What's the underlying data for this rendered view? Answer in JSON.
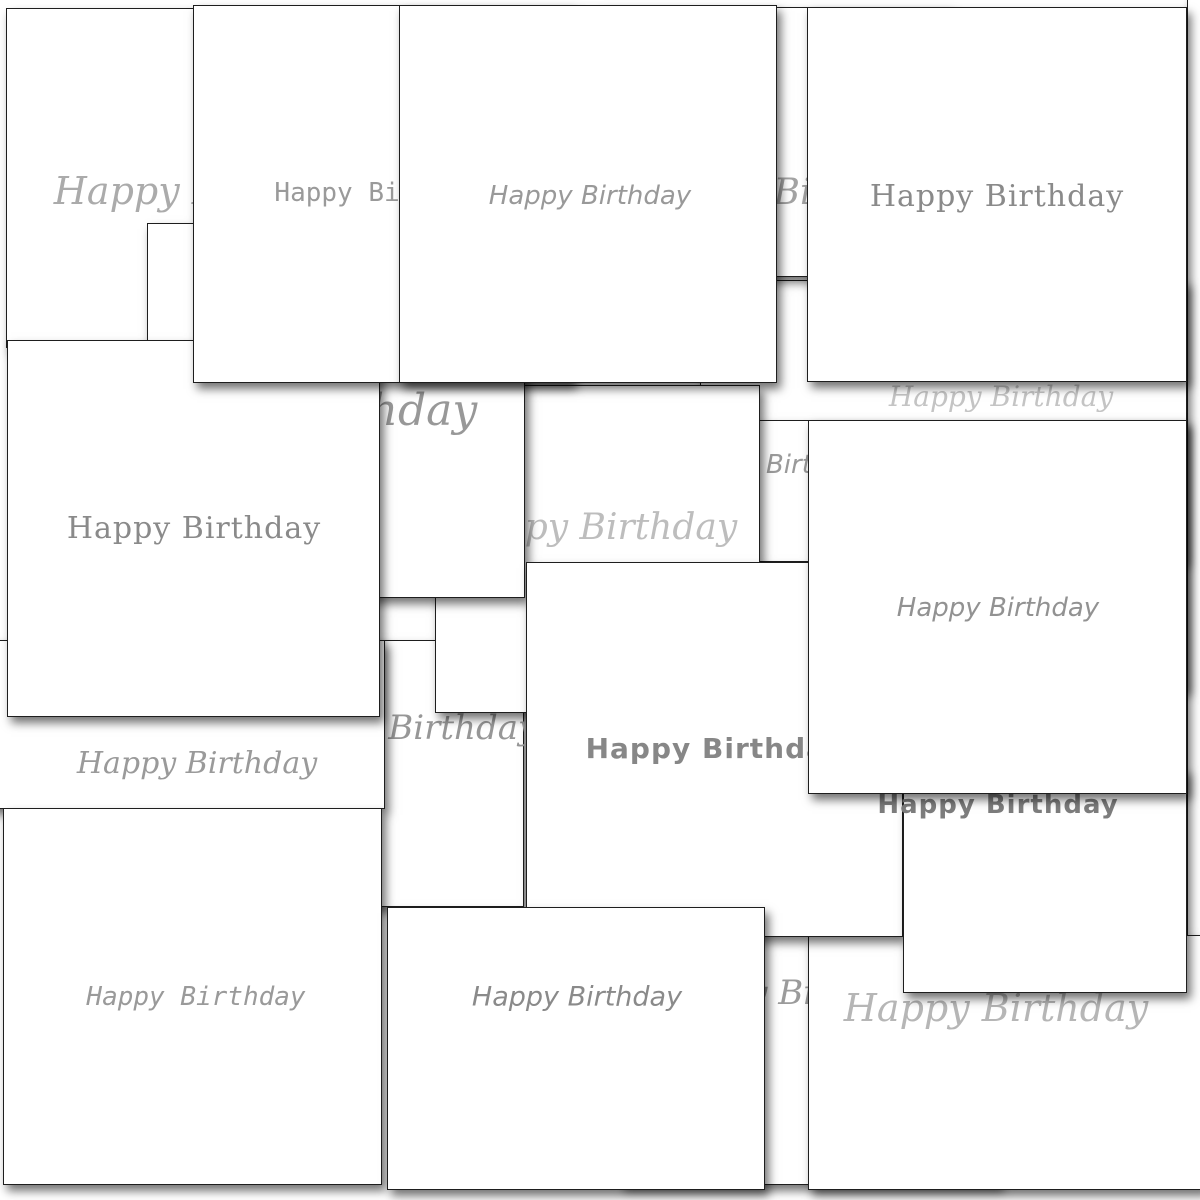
{
  "image": {
    "title": "Collage of overlapping white Happy Birthday note cards",
    "background": "#ffffff"
  },
  "greeting_text": "Happy Birthday",
  "card_style": {
    "background": "#ffffff",
    "border_color": "#1e1e1e",
    "shadow": "4px 6px 9px rgba(0,0,0,0.55)"
  },
  "cards": [
    {
      "id": "card-right-edge-sliver",
      "label": "",
      "font": "f-script",
      "size": 0,
      "color": "#ffffff",
      "x": 1187,
      "y": -5,
      "w": 28,
      "h": 950,
      "z": 1,
      "tx": 0,
      "ty": 0
    },
    {
      "id": "card-faded-script-band",
      "label": "Happy Birthday",
      "font": "f-script",
      "size": 28,
      "color": "#c4c4c4",
      "x": 700,
      "y": 280,
      "w": 487,
      "h": 410,
      "z": 2,
      "tx": 1000,
      "ty": 396
    },
    {
      "id": "card-handwriting-strip",
      "label": "Happy Birthday",
      "font": "f-hand",
      "size": 26,
      "color": "#9a9a9a",
      "x": 610,
      "y": 420,
      "w": 575,
      "h": 142,
      "z": 3,
      "tx": 774,
      "ty": 464
    },
    {
      "id": "card-top-left-thin-script",
      "label": "Happy Birthday",
      "font": "f-script",
      "size": 38,
      "color": "#ababab",
      "x": 6,
      "y": 8,
      "w": 394,
      "h": 340,
      "z": 4,
      "tx": 205,
      "ty": 190
    },
    {
      "id": "card-top-script-strip",
      "label": "Happy Birthday",
      "font": "f-script",
      "size": 36,
      "color": "#a3a3a3",
      "x": 600,
      "y": 7,
      "w": 350,
      "h": 270,
      "z": 5,
      "tx": 786,
      "ty": 192
    },
    {
      "id": "card-flourish-script-strip",
      "label": "Happy Birthday",
      "font": "f-script",
      "size": 34,
      "color": "#979797",
      "x": 180,
      "y": 640,
      "w": 344,
      "h": 267,
      "z": 6,
      "tx": 400,
      "ty": 727
    },
    {
      "id": "card-signature-script-band",
      "label": "Happy Birthday",
      "font": "f-script",
      "size": 30,
      "color": "#9a9a9a",
      "x": -20,
      "y": 640,
      "w": 405,
      "h": 169,
      "z": 7,
      "tx": 196,
      "ty": 763
    },
    {
      "id": "card-faded-script-middle",
      "label": "Happy Birthday",
      "font": "f-script",
      "size": 36,
      "color": "#bdbdbd",
      "x": 435,
      "y": 385,
      "w": 325,
      "h": 328,
      "z": 8,
      "tx": 592,
      "ty": 527
    },
    {
      "id": "card-curl-script-left",
      "label": "Happy Birthday",
      "font": "f-script",
      "size": 44,
      "color": "#989898",
      "x": 147,
      "y": 223,
      "w": 378,
      "h": 375,
      "z": 9,
      "tx": 300,
      "ty": 410
    },
    {
      "id": "card-curly-script-bottom",
      "label": "Happy Birthday",
      "font": "f-script",
      "size": 34,
      "color": "#9b9b9b",
      "x": 620,
      "y": 800,
      "w": 380,
      "h": 385,
      "z": 10,
      "tx": 790,
      "ty": 992
    },
    {
      "id": "card-thin-script-bottom-right",
      "label": "Happy Birthday",
      "font": "f-script",
      "size": 38,
      "color": "#b6b6b6",
      "x": 808,
      "y": 935,
      "w": 397,
      "h": 255,
      "z": 11,
      "tx": 995,
      "ty": 1007
    },
    {
      "id": "card-bold-sans-middle",
      "label": "Happy Birthday",
      "font": "f-bold-sans",
      "size": 28,
      "color": "#878787",
      "x": 526,
      "y": 562,
      "w": 377,
      "h": 375,
      "z": 12,
      "tx": 714,
      "ty": 748
    },
    {
      "id": "card-serif-left",
      "label": "Happy Birthday",
      "font": "f-serif",
      "size": 30,
      "color": "#8a8a8a",
      "x": 7,
      "y": 340,
      "w": 373,
      "h": 377,
      "z": 13,
      "tx": 193,
      "ty": 528
    },
    {
      "id": "card-typewriter-bottom-left",
      "label": "Happy Birthday",
      "font": "f-mono-italic",
      "size": 26,
      "color": "#9a9a9a",
      "x": 3,
      "y": 808,
      "w": 379,
      "h": 377,
      "z": 14,
      "tx": 195,
      "ty": 996
    },
    {
      "id": "card-print-bottom-center",
      "label": "Happy Birthday",
      "font": "f-hand",
      "size": 27,
      "color": "#8a8a8a",
      "x": 387,
      "y": 907,
      "w": 378,
      "h": 283,
      "z": 15,
      "tx": 576,
      "ty": 996
    },
    {
      "id": "card-bold-sans-bottom-right",
      "label": "Happy Birthday",
      "font": "f-bold-sans",
      "size": 26,
      "color": "#7d7d7d",
      "x": 903,
      "y": 768,
      "w": 284,
      "h": 225,
      "z": 16,
      "tx": 997,
      "ty": 804
    },
    {
      "id": "card-typewriter-top",
      "label": "Happy Birthday",
      "font": "f-mono",
      "size": 26,
      "color": "#9a9a9a",
      "x": 193,
      "y": 5,
      "w": 380,
      "h": 378,
      "z": 17,
      "tx": 383,
      "ty": 192
    },
    {
      "id": "card-print-top-center",
      "label": "Happy Birthday",
      "font": "f-hand",
      "size": 26,
      "color": "#999999",
      "x": 399,
      "y": 5,
      "w": 378,
      "h": 378,
      "z": 18,
      "tx": 589,
      "ty": 195
    },
    {
      "id": "card-serif-top-right",
      "label": "Happy Birthday",
      "font": "f-serif",
      "size": 30,
      "color": "#8a8a8a",
      "x": 807,
      "y": 7,
      "w": 380,
      "h": 375,
      "z": 19,
      "tx": 996,
      "ty": 196
    },
    {
      "id": "card-print-right-middle",
      "label": "Happy Birthday",
      "font": "f-hand",
      "size": 26,
      "color": "#929292",
      "x": 808,
      "y": 420,
      "w": 379,
      "h": 374,
      "z": 20,
      "tx": 997,
      "ty": 607
    }
  ]
}
